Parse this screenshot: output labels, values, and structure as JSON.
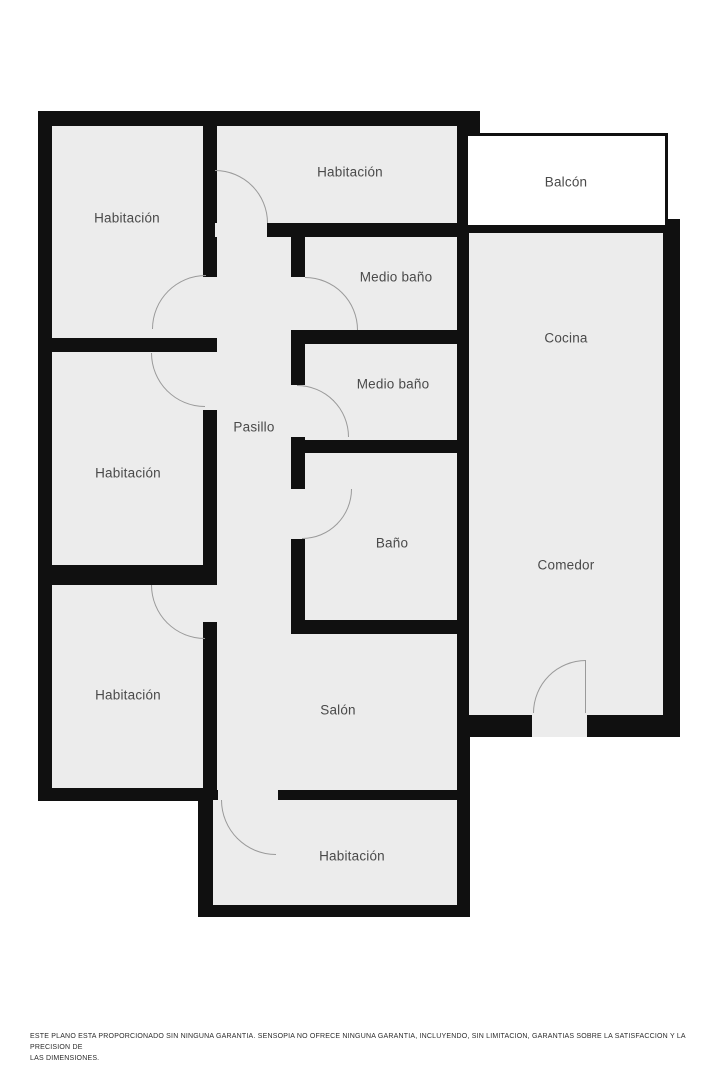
{
  "plan": {
    "canvas": {
      "width": 719,
      "height": 1079,
      "background": "#ffffff"
    },
    "colors": {
      "wall": "#101010",
      "room_fill": "#ececec",
      "balcony_fill": "#ffffff",
      "door_arc": "#9a9a9a",
      "label": "#4a4a4a"
    },
    "black_blocks": [
      {
        "name": "structure-left-center",
        "rect": [
          38,
          111,
          432,
          690
        ]
      },
      {
        "name": "structure-bottom-center",
        "rect": [
          198,
          785,
          272,
          132
        ]
      },
      {
        "name": "structure-right",
        "rect": [
          455,
          219,
          225,
          518
        ]
      },
      {
        "name": "structure-top-stub",
        "rect": [
          455,
          111,
          25,
          28
        ]
      }
    ],
    "rooms": [
      {
        "id": "habitacion-top-left",
        "rect": [
          52,
          126,
          151,
          212
        ]
      },
      {
        "id": "habitacion-top-middle",
        "rect": [
          217,
          126,
          240,
          97
        ]
      },
      {
        "id": "pasillo",
        "rect": [
          217,
          237,
          74,
          397
        ]
      },
      {
        "id": "medio-bano-1",
        "rect": [
          305,
          237,
          152,
          93
        ]
      },
      {
        "id": "medio-bano-2",
        "rect": [
          305,
          344,
          152,
          96
        ]
      },
      {
        "id": "bano",
        "rect": [
          305,
          453,
          152,
          167
        ]
      },
      {
        "id": "habitacion-middle-left",
        "rect": [
          52,
          352,
          151,
          213
        ]
      },
      {
        "id": "habitacion-bottom-left",
        "rect": [
          52,
          585,
          151,
          203
        ]
      },
      {
        "id": "salon",
        "rect": [
          217,
          634,
          240,
          156
        ]
      },
      {
        "id": "habitacion-bottom",
        "rect": [
          213,
          800,
          244,
          105
        ]
      },
      {
        "id": "cocina-comedor",
        "rect": [
          469,
          233,
          194,
          482
        ]
      },
      {
        "id": "balcon",
        "rect": [
          465,
          133,
          203,
          95
        ],
        "fill": "#ffffff",
        "outlined": true
      }
    ],
    "door_gaps": [
      {
        "name": "door-gap-habitacion-top-middle",
        "rect": [
          215,
          223,
          52,
          14
        ]
      },
      {
        "name": "door-gap-habitacion-top-left",
        "rect": [
          203,
          277,
          14,
          61
        ]
      },
      {
        "name": "door-gap-habitacion-middle-left",
        "rect": [
          203,
          352,
          14,
          58
        ]
      },
      {
        "name": "door-gap-medio-bano-1",
        "rect": [
          291,
          277,
          14,
          53
        ]
      },
      {
        "name": "door-gap-medio-bano-2",
        "rect": [
          291,
          385,
          14,
          52
        ]
      },
      {
        "name": "door-gap-bano",
        "rect": [
          291,
          489,
          14,
          50
        ]
      },
      {
        "name": "door-gap-habitacion-bottom-left",
        "rect": [
          203,
          585,
          14,
          37
        ]
      },
      {
        "name": "door-gap-habitacion-bottom",
        "rect": [
          218,
          788,
          60,
          14
        ]
      },
      {
        "name": "door-gap-entrance",
        "rect": [
          532,
          713,
          55,
          24
        ]
      }
    ],
    "door_arcs": [
      {
        "name": "door-arc-habitacion-top-middle",
        "rect": [
          215,
          170,
          53,
          53
        ],
        "corner": "top-right"
      },
      {
        "name": "door-arc-habitacion-top-left",
        "rect": [
          152,
          275,
          54,
          54
        ],
        "corner": "top-left"
      },
      {
        "name": "door-arc-habitacion-middle-left",
        "rect": [
          151,
          353,
          54,
          54
        ],
        "corner": "bottom-left"
      },
      {
        "name": "door-arc-medio-bano-1",
        "rect": [
          305,
          277,
          53,
          53
        ],
        "corner": "top-right"
      },
      {
        "name": "door-arc-medio-bano-2",
        "rect": [
          297,
          385,
          52,
          52
        ],
        "corner": "top-right"
      },
      {
        "name": "door-arc-bano",
        "rect": [
          302,
          489,
          50,
          50
        ],
        "corner": "bottom-right"
      },
      {
        "name": "door-arc-habitacion-bottom-left",
        "rect": [
          151,
          585,
          54,
          54
        ],
        "corner": "bottom-left"
      },
      {
        "name": "door-arc-habitacion-bottom",
        "rect": [
          221,
          800,
          55,
          55
        ],
        "corner": "bottom-left"
      },
      {
        "name": "door-arc-entrance",
        "rect": [
          533,
          660,
          53,
          53
        ],
        "corner": "top-left",
        "leaf": "right"
      }
    ],
    "labels": [
      {
        "id": "habitacion-top-left",
        "text": "Habitación",
        "x": 127,
        "y": 218
      },
      {
        "id": "habitacion-top-middle",
        "text": "Habitación",
        "x": 350,
        "y": 172
      },
      {
        "id": "balcon",
        "text": "Balcón",
        "x": 566,
        "y": 182
      },
      {
        "id": "medio-bano-1",
        "text": "Medio baño",
        "x": 396,
        "y": 277
      },
      {
        "id": "cocina",
        "text": "Cocina",
        "x": 566,
        "y": 338
      },
      {
        "id": "medio-bano-2",
        "text": "Medio baño",
        "x": 393,
        "y": 384
      },
      {
        "id": "pasillo",
        "text": "Pasillo",
        "x": 254,
        "y": 427
      },
      {
        "id": "habitacion-middle-left",
        "text": "Habitación",
        "x": 128,
        "y": 473
      },
      {
        "id": "bano",
        "text": "Baño",
        "x": 392,
        "y": 543
      },
      {
        "id": "comedor",
        "text": "Comedor",
        "x": 566,
        "y": 565
      },
      {
        "id": "habitacion-bottom-left",
        "text": "Habitación",
        "x": 128,
        "y": 695
      },
      {
        "id": "salon",
        "text": "Salón",
        "x": 338,
        "y": 710
      },
      {
        "id": "habitacion-bottom",
        "text": "Habitación",
        "x": 352,
        "y": 856
      }
    ]
  },
  "footer": {
    "disclaimer": "ESTE PLANO ESTA PROPORCIONADO SIN NINGUNA GARANTIA. SENSOPIA NO OFRECE NINGUNA GARANTIA, INCLUYENDO, SIN LIMITACION, GARANTIAS SOBRE LA SATISFACCION Y LA PRECISION DE\nLAS DIMENSIONES."
  }
}
